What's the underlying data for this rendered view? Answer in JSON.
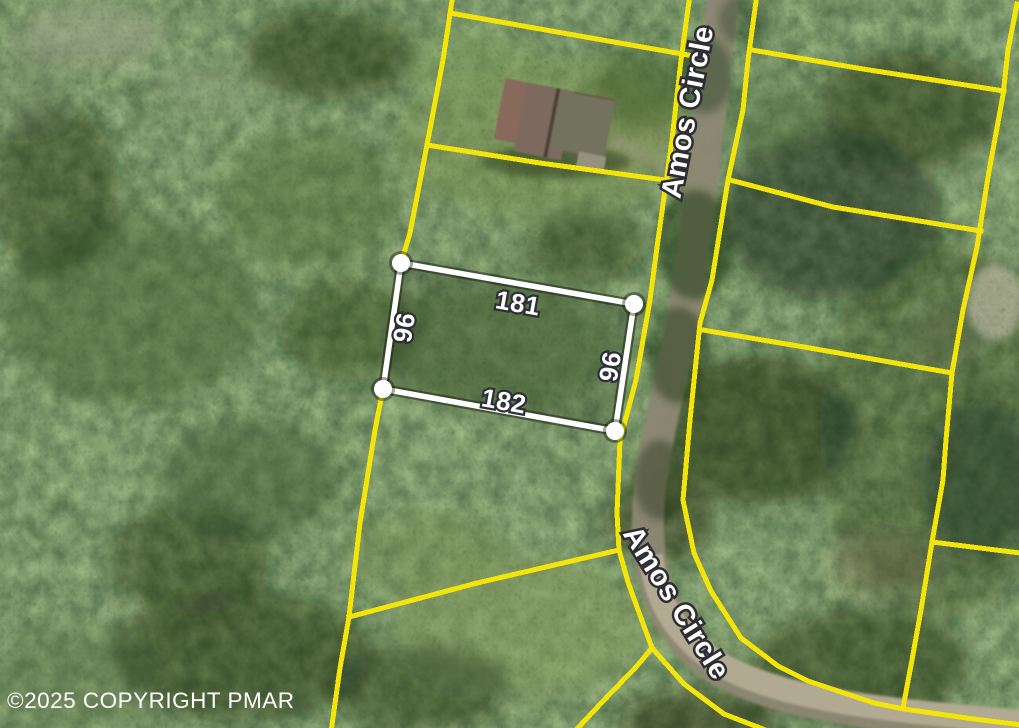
{
  "map": {
    "type": "satellite-parcel-overlay",
    "street": {
      "name": "Amos Circle",
      "labels": {
        "north": "Amos Circle",
        "south": "Amos Circle"
      }
    },
    "highlighted_parcel": {
      "dimensions": {
        "top": "181",
        "bottom": "182",
        "left": "96",
        "right": "96"
      },
      "outline_color": "#ffffff"
    },
    "boundary_line_color": "#f3e50a",
    "label_text_color": "#ffffff",
    "label_outline_color": "#2c2f38",
    "palette": {
      "forest_dark": "#16260e",
      "forest_mid": "#3f5c31",
      "forest_light": "#7e9556",
      "road_surface": "#8d8672",
      "road_sunlit": "#b6ae96"
    },
    "watermark": "©2025 COPYRIGHT PMAR"
  }
}
